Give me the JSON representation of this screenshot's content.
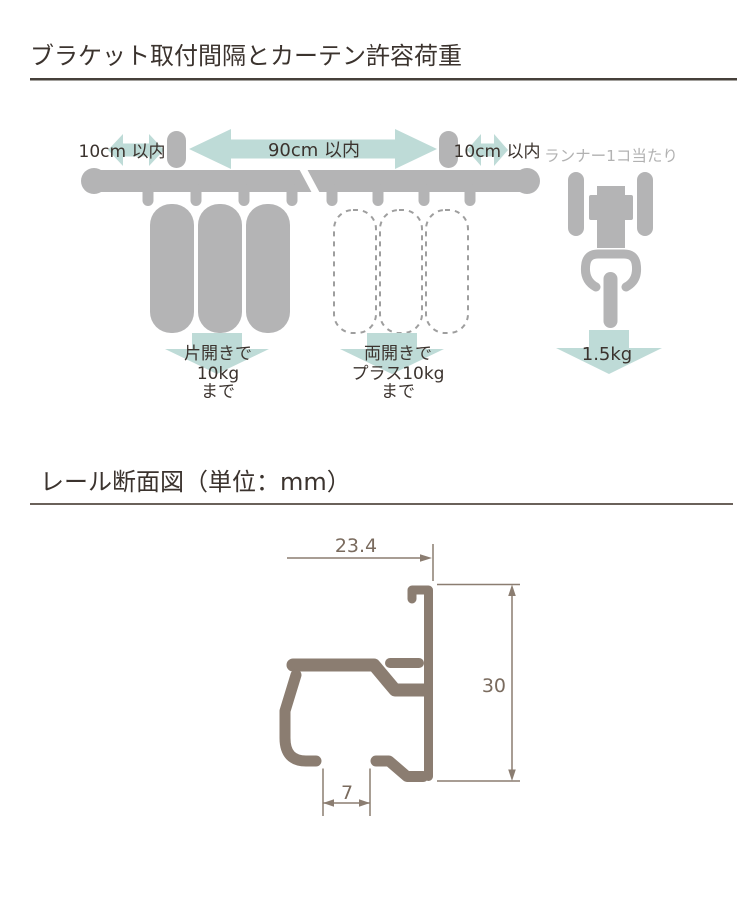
{
  "section1": {
    "title": "ブラケット取付間隔とカーテン許容荷重",
    "spacing_left": "10cm 以内",
    "spacing_center": "90cm 以内",
    "spacing_right": "10cm 以内",
    "runner_caption": "ランナー1コ当たり",
    "runner_load": "1.5kg",
    "single_open": {
      "line1": "片開きで",
      "line2": "10kg",
      "line3": "まで"
    },
    "double_open": {
      "line1": "両開きで",
      "line2": "プラス10kg",
      "line3": "まで"
    }
  },
  "section2": {
    "title": "レール断面図（単位：mm）",
    "width_mm": "23.4",
    "height_mm": "30",
    "slot_mm": "7"
  },
  "colors": {
    "shape_gray": "#b4b4b5",
    "accent_teal": "#bedbd7",
    "text_dark": "#3b332e",
    "text_gray": "#b2b2b2",
    "profile_brown": "#8b7d71",
    "dim_text_brown": "#7a6b5e",
    "heading_rule_dark": "#46403a",
    "heading_rule_light": "#6a615a",
    "dashed_outline_gray": "#9e9e9e",
    "background": "#ffffff"
  }
}
